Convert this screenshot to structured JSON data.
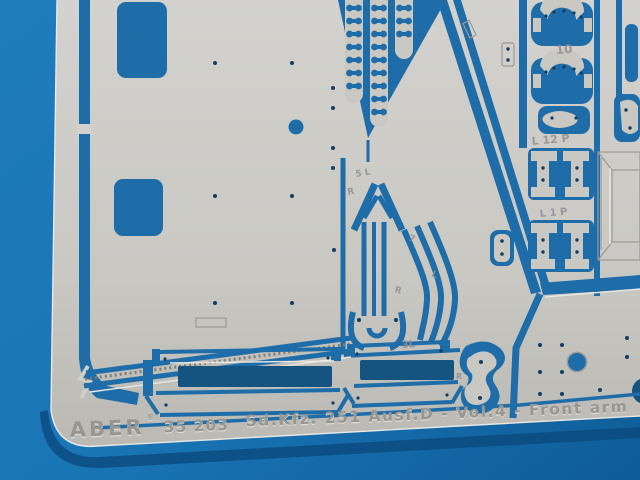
{
  "photo": {
    "subject": "Photograph of an ABER photo-etched metal detail fret (scale model accessory) lying on a blue background",
    "colors": {
      "background_blue": "#1a75b5",
      "background_blue_dark": "#0b5590",
      "shadow_blue": "#0a4a7e",
      "fret_silver": "#cbcac5",
      "fret_silver_light": "#d6d5d1",
      "fret_silver_dark": "#b5b4af",
      "cutout_blue": "#1e6ca8",
      "cutout_blue_shadow": "#155381",
      "hole_dark": "#123c60",
      "etched_grey": "#9b9a95"
    }
  },
  "etched_markings": {
    "brand": "ABER",
    "registered": "®",
    "catalog_number": "35 203",
    "title": "Sd.Kfz. 251 Ausf.D - Vol.4 - Front arm",
    "part_labels": {
      "bracket_pair": "10",
      "hinge_row_top": "L 12 P",
      "hinge_row_bottom": "L 1 P",
      "arrow_top": "5 L",
      "arrow_left": "R",
      "strip_7": "7",
      "strip_l": "L",
      "strip_r": "R",
      "strip_3l": "3L",
      "fender_r": "R"
    }
  }
}
